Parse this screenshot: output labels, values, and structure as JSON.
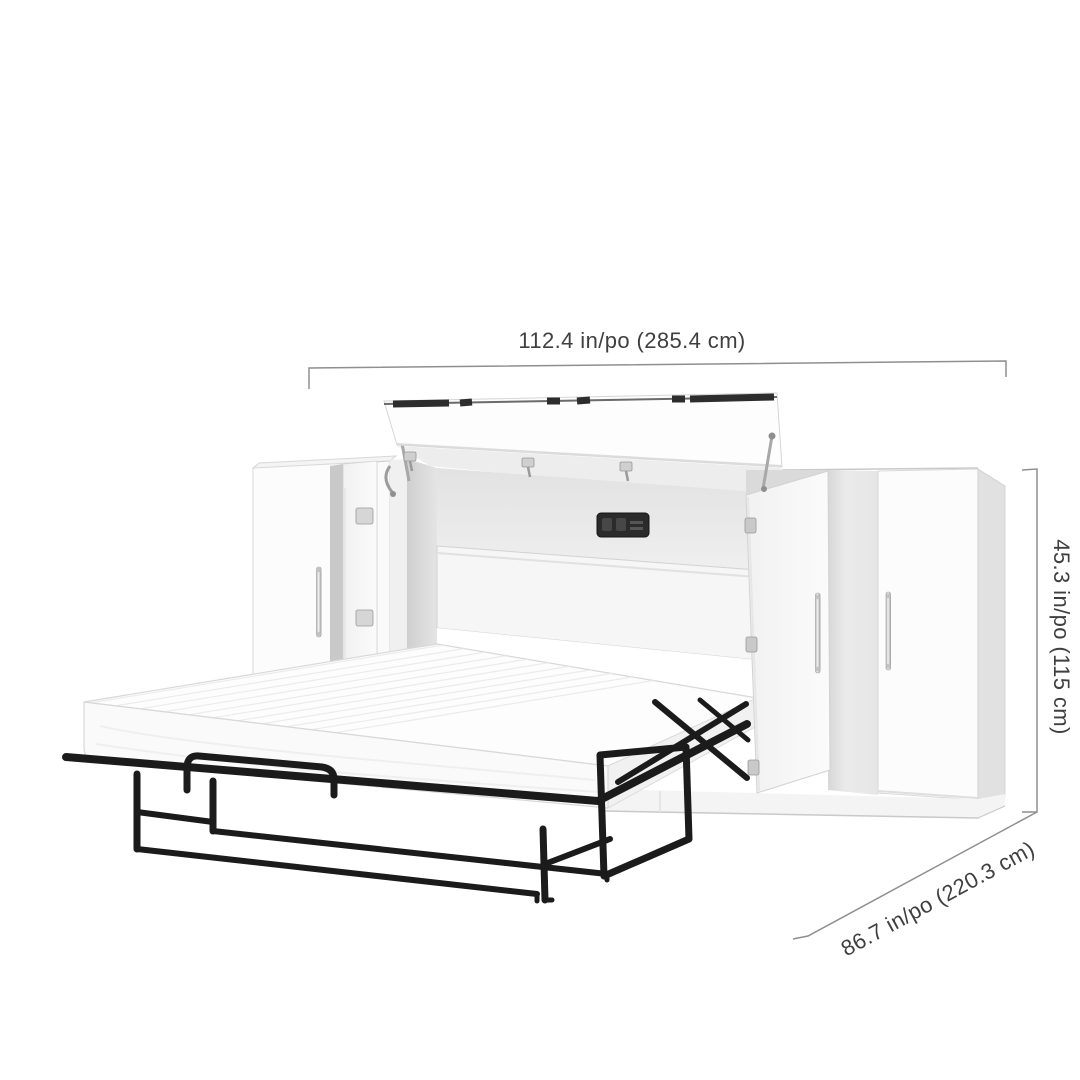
{
  "product": {
    "name": "cabinet bed with pull-out mattress and two side storage cabinets",
    "colors": {
      "cabinet": "#fcfcfc",
      "bed_frame": "#1b1b1b",
      "dimension_line": "#8f8f8f",
      "dimension_text": "#3f3f3f"
    }
  },
  "dimensions": {
    "width": {
      "label": "112.4 in/po (285.4 cm)"
    },
    "height": {
      "label": "45.3 in/po (115 cm)"
    },
    "depth": {
      "label": "86.7 in/po (220.3 cm)"
    }
  }
}
